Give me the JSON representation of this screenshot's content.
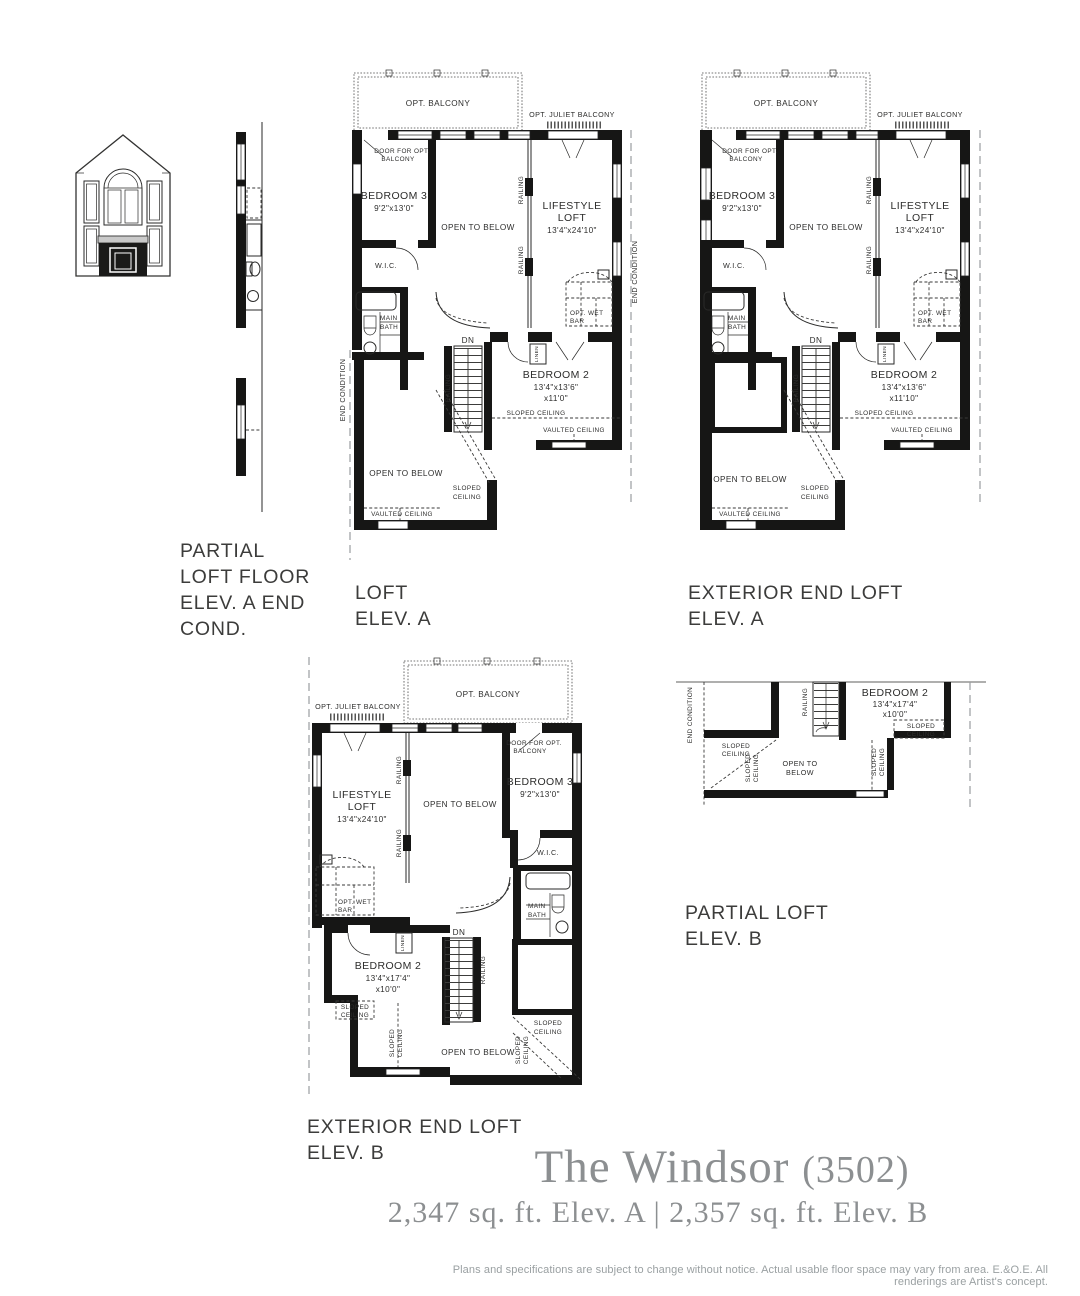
{
  "meta": {
    "title": "The Windsor",
    "model_number": "(3502)",
    "area_line": "2,347 sq. ft. Elev. A  |  2,357 sq. ft. Elev. B",
    "disclaimer": "Plans and specifications are subject to change without notice. Actual usable floor space may vary from area. E.&O.E. All renderings are Artist's concept."
  },
  "colors": {
    "linework": "#161615",
    "label_text": "#2d2d2c",
    "section_text": "#3c3c3b",
    "title_gray": "#8c8f91",
    "disclaimer_gray": "#9aa0a2"
  },
  "sections": {
    "partial_a": {
      "line1": "PARTIAL",
      "line2": "LOFT FLOOR",
      "line3": "ELEV. A END",
      "line4": "COND."
    },
    "loft_a": {
      "line1": "LOFT",
      "line2": "ELEV. A"
    },
    "ext_a": {
      "line1": "EXTERIOR END LOFT",
      "line2": "ELEV. A"
    },
    "ext_b": {
      "line1": "EXTERIOR END LOFT",
      "line2": "ELEV. B"
    },
    "partial_b": {
      "line1": "PARTIAL LOFT",
      "line2": "ELEV. B"
    }
  },
  "plan_labels": {
    "opt_balcony": "OPT. BALCONY",
    "opt_juliet_balcony": "OPT. JULIET BALCONY",
    "door_opt_1": "DOOR FOR OPT.",
    "door_opt_2": "BALCONY",
    "bedroom3": "BEDROOM 3",
    "bedroom3_dims": "9'2\"x13'0\"",
    "open_to_below": "OPEN TO BELOW",
    "open_to": "OPEN TO",
    "below": "BELOW",
    "railing": "RAILING",
    "lifestyle": "LIFESTYLE",
    "loft": "LOFT",
    "lifestyle_dims": "13'4\"x24'10\"",
    "wic": "W.I.C.",
    "main": "MAIN",
    "bath": "BATH",
    "opt_wet": "OPT. WET",
    "bar": "BAR",
    "end_condition": "END CONDITION",
    "dn": "DN",
    "linen": "LINEN",
    "bedroom2": "BEDROOM 2",
    "sloped_ceiling": "SLOPED CEILING",
    "sloped": "SLOPED",
    "ceiling": "CEILING",
    "vaulted_ceiling": "VAULTED CEILING"
  },
  "bedroom2_dims": {
    "loft_a": {
      "wh": "13'4\"x13'6\"",
      "h": "x11'0\""
    },
    "ext_a": {
      "wh": "13'4\"x13'6\"",
      "h": "x11'10\""
    },
    "ext_b": {
      "wh": "13'4\"x17'4\"",
      "h": "x10'0\""
    },
    "partial_b": {
      "wh": "13'4\"x17'4\"",
      "h": "x10'0\""
    }
  }
}
